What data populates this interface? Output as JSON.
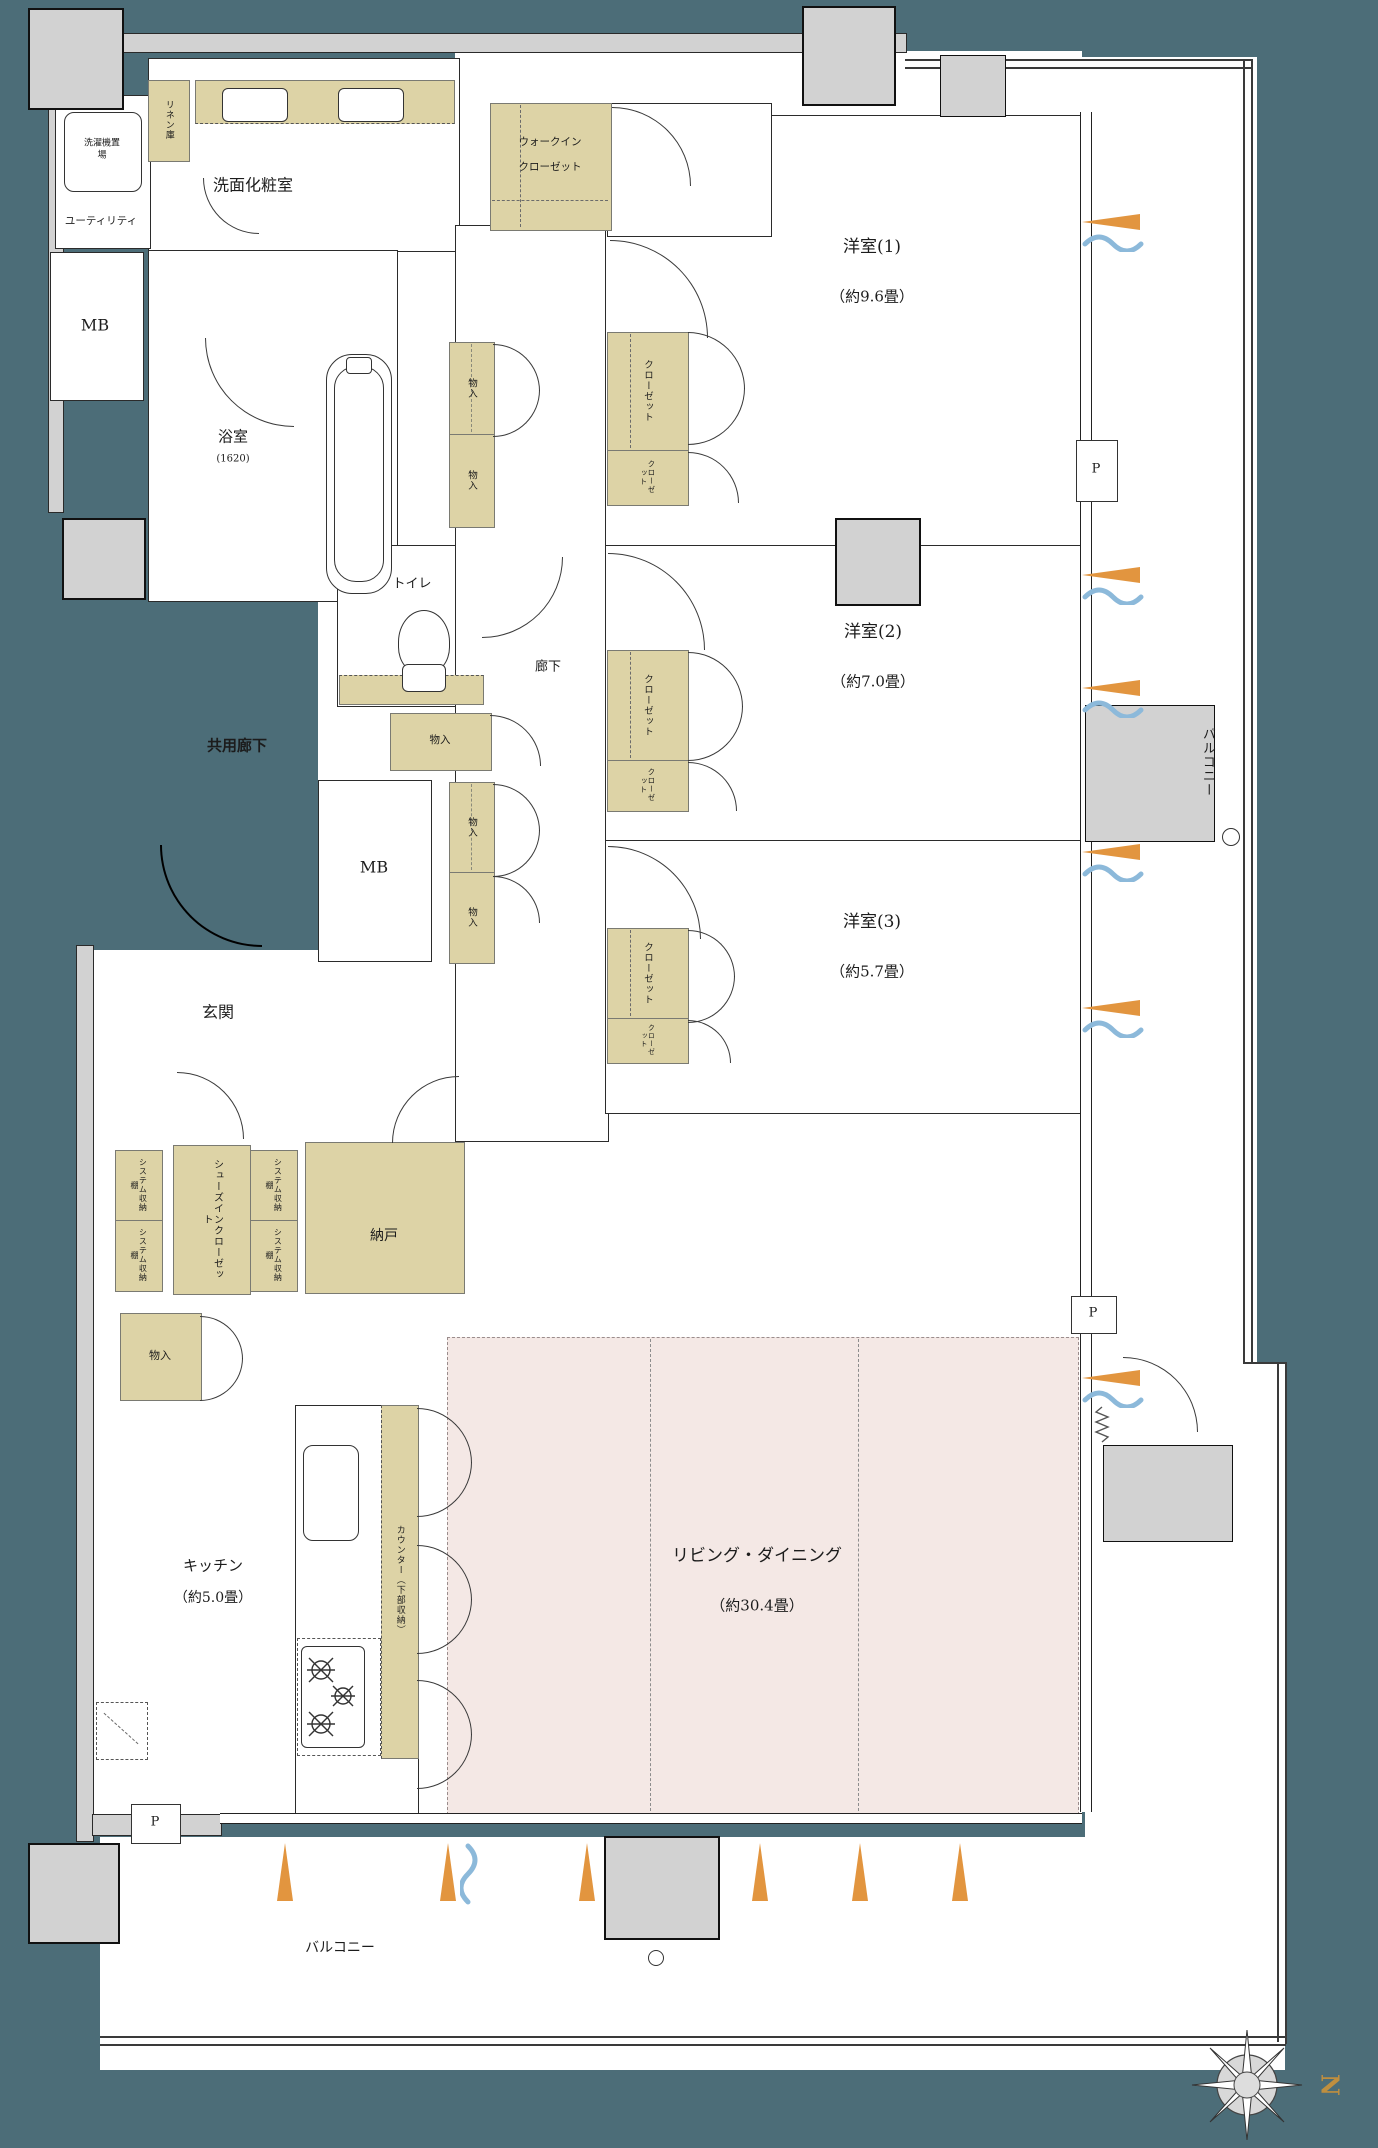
{
  "colors": {
    "teal": "#4c6d78",
    "tan": "#ddd3a6",
    "pink": "#f4e8e5",
    "gray_wall": "#d2d2d2",
    "orange_marker": "#e2953f",
    "blue_airflow": "#8cb9da",
    "gold_north": "#bf8f3f"
  },
  "rooms": {
    "common_corridor": "共用廊下",
    "entrance": "玄関",
    "corridor": "廊下",
    "powder_room": "洗面化粧室",
    "utility": "ユーティリティ",
    "washer": "洗濯機置場",
    "linen": "リネン庫",
    "bath": "浴室",
    "bath_size": "(1620)",
    "toilet": "トイレ",
    "mb": "MB",
    "bedroom1": "洋室(1)",
    "bedroom1_size": "（約9.6畳）",
    "bedroom2": "洋室(2)",
    "bedroom2_size": "（約7.0畳）",
    "bedroom3": "洋室(3)",
    "bedroom3_size": "（約5.7畳）",
    "kitchen": "キッチン",
    "kitchen_size": "（約5.0畳）",
    "living": "リビング・ダイニング",
    "living_size": "（約30.4畳）",
    "storeroom": "納戸",
    "shoes_closet": "シューズインクローゼット",
    "wic_line1": "ウォークイン",
    "wic_line2": "クローゼット",
    "counter": "カウンター（下部収納）",
    "balcony": "バルコニー"
  },
  "storage": {
    "closet": "クローゼット",
    "mono_ire": "物入",
    "system_shelf": "システム収納棚"
  },
  "marks": {
    "pipe": "P",
    "north": "N"
  }
}
